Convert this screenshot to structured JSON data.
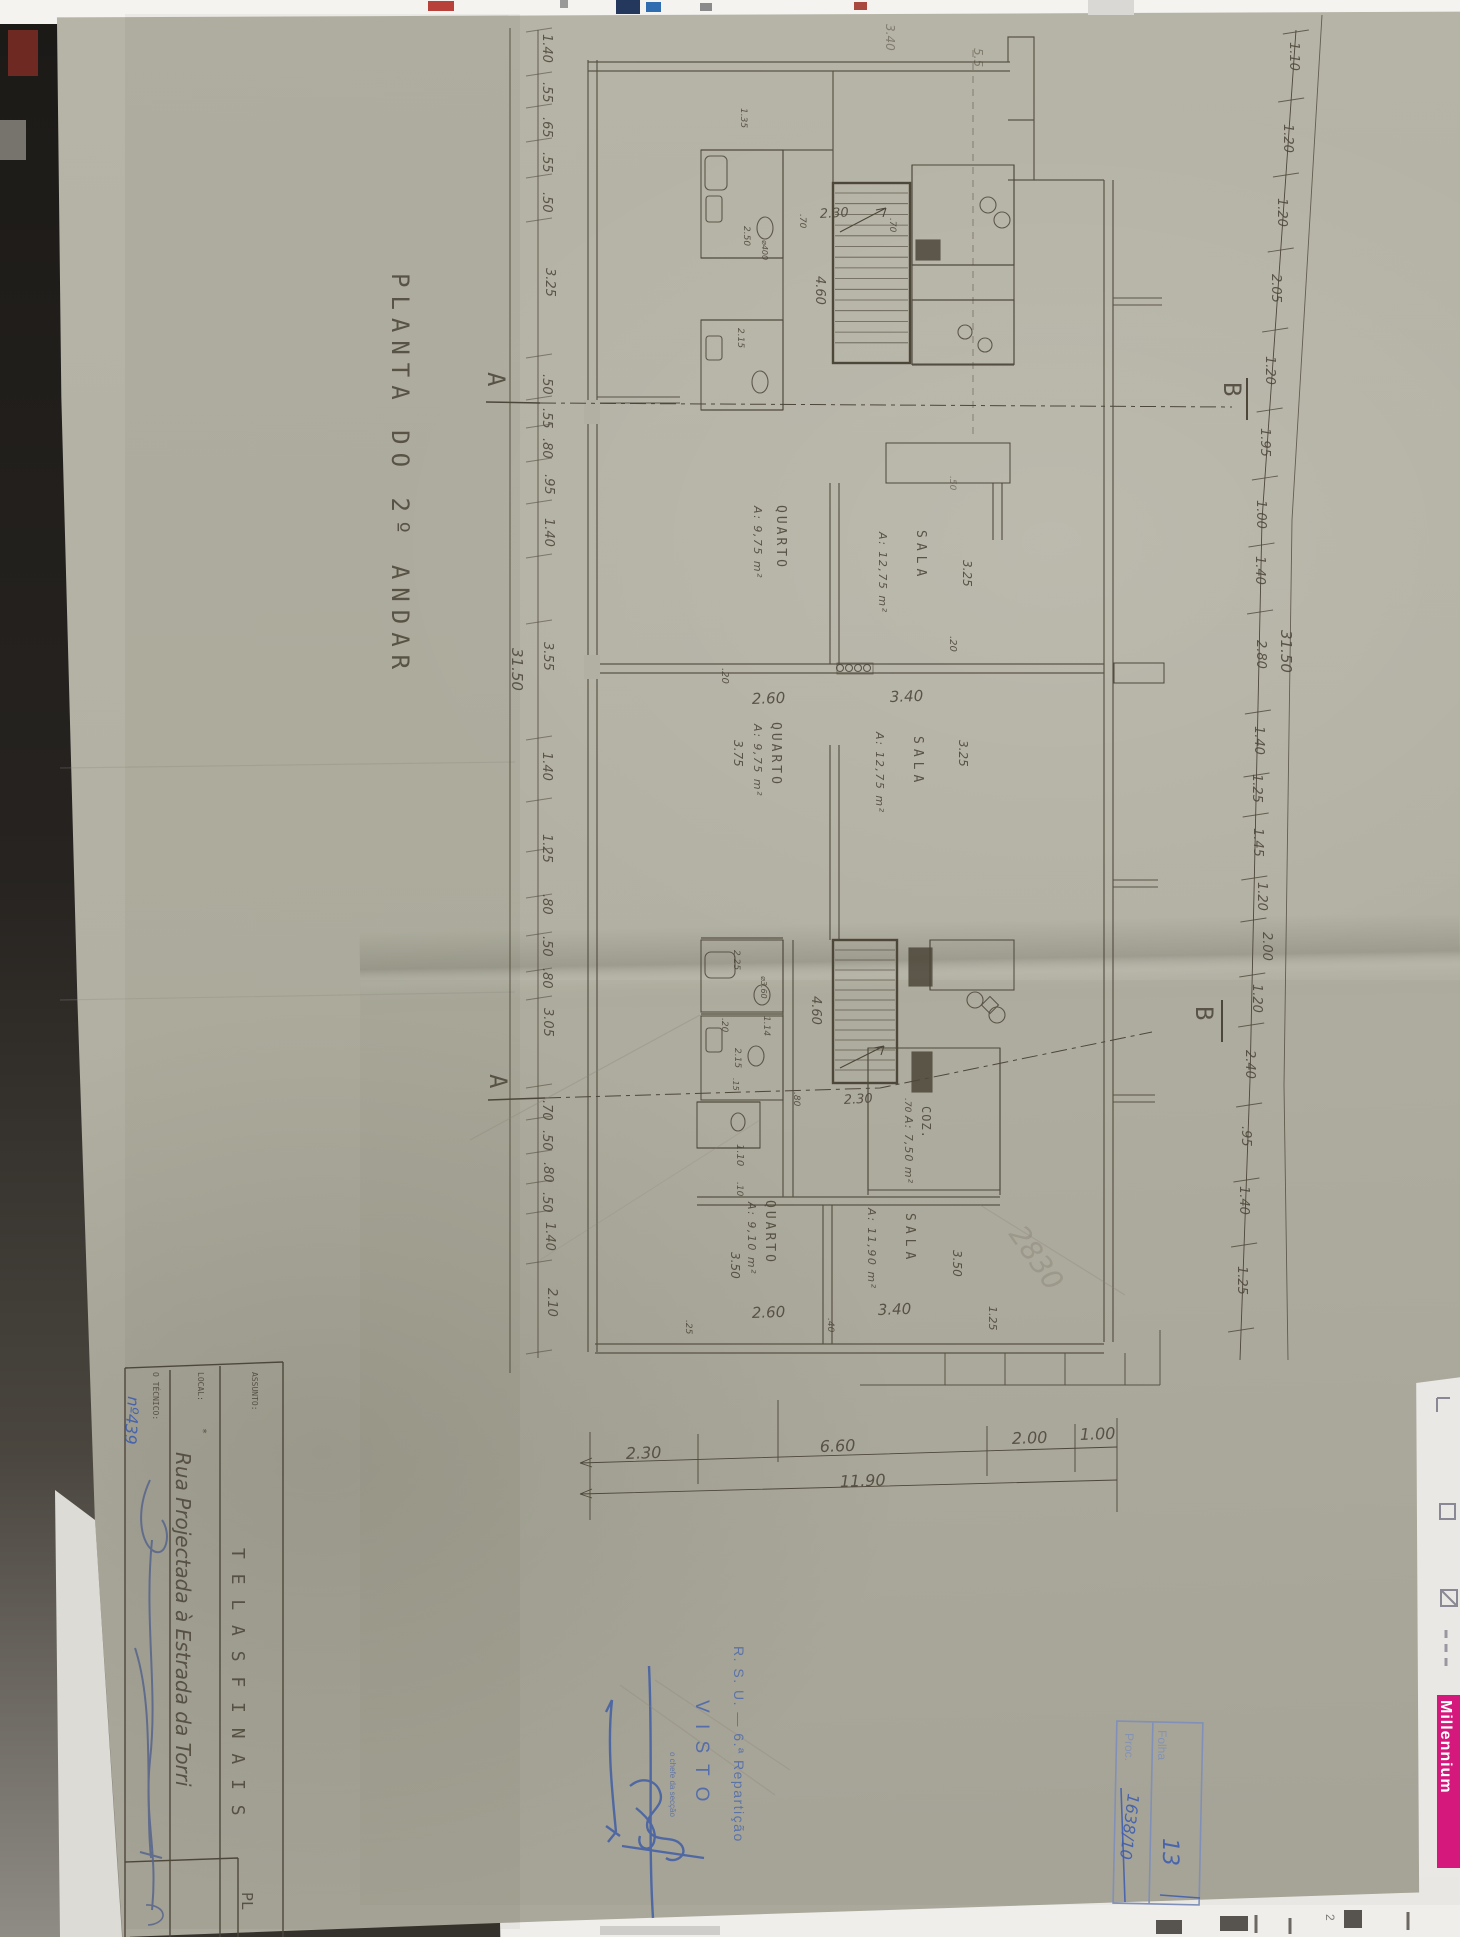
{
  "document_type": "architectural floor plan photograph",
  "texts": [
    {
      "n": "drawing-title",
      "t": "PLANTA  DO  2º ANDAR",
      "x": 392,
      "y": 273,
      "r": 90,
      "s": 24,
      "f": "d",
      "c": "ink",
      "ls": 8
    },
    {
      "n": "dim-left",
      "t": "1.40",
      "x": 543,
      "y": 34,
      "r": 90,
      "s": 13,
      "f": "h"
    },
    {
      "n": "dim-left",
      "t": ".55",
      "x": 543,
      "y": 82,
      "r": 90,
      "s": 13,
      "f": "h"
    },
    {
      "n": "dim-left",
      "t": ".65",
      "x": 543,
      "y": 117,
      "r": 90,
      "s": 13,
      "f": "h"
    },
    {
      "n": "dim-left",
      "t": ".55",
      "x": 543,
      "y": 152,
      "r": 90,
      "s": 13,
      "f": "h"
    },
    {
      "n": "dim-left",
      "t": ".50",
      "x": 543,
      "y": 192,
      "r": 90,
      "s": 13,
      "f": "h"
    },
    {
      "n": "dim-left",
      "t": "3.25",
      "x": 546,
      "y": 268,
      "r": 90,
      "s": 13,
      "f": "h"
    },
    {
      "n": "dim-left",
      "t": ".50",
      "x": 543,
      "y": 374,
      "r": 90,
      "s": 13,
      "f": "h"
    },
    {
      "n": "dim-left",
      "t": ".55",
      "x": 543,
      "y": 408,
      "r": 90,
      "s": 13,
      "f": "h"
    },
    {
      "n": "dim-left",
      "t": ".80",
      "x": 543,
      "y": 438,
      "r": 90,
      "s": 13,
      "f": "h"
    },
    {
      "n": "dim-left",
      "t": ".95",
      "x": 545,
      "y": 474,
      "r": 90,
      "s": 13,
      "f": "h"
    },
    {
      "n": "dim-left",
      "t": "1.40",
      "x": 545,
      "y": 518,
      "r": 90,
      "s": 13,
      "f": "h"
    },
    {
      "n": "dim-left",
      "t": "3.55",
      "x": 544,
      "y": 642,
      "r": 90,
      "s": 13,
      "f": "h"
    },
    {
      "n": "dim-left",
      "t": "1.40",
      "x": 543,
      "y": 752,
      "r": 90,
      "s": 13,
      "f": "h"
    },
    {
      "n": "dim-left",
      "t": "1.25",
      "x": 543,
      "y": 834,
      "r": 90,
      "s": 13,
      "f": "h"
    },
    {
      "n": "dim-left",
      "t": ".80",
      "x": 543,
      "y": 894,
      "r": 90,
      "s": 13,
      "f": "h"
    },
    {
      "n": "dim-left",
      "t": ".50",
      "x": 543,
      "y": 936,
      "r": 90,
      "s": 13,
      "f": "h"
    },
    {
      "n": "dim-left",
      "t": ".80",
      "x": 543,
      "y": 968,
      "r": 90,
      "s": 13,
      "f": "h"
    },
    {
      "n": "dim-left",
      "t": "3.05",
      "x": 544,
      "y": 1008,
      "r": 90,
      "s": 13,
      "f": "h"
    },
    {
      "n": "dim-left",
      "t": ".70",
      "x": 543,
      "y": 1100,
      "r": 90,
      "s": 13,
      "f": "h"
    },
    {
      "n": "dim-left",
      "t": ".50",
      "x": 543,
      "y": 1130,
      "r": 90,
      "s": 13,
      "f": "h"
    },
    {
      "n": "dim-left",
      "t": ".80",
      "x": 544,
      "y": 1162,
      "r": 90,
      "s": 13,
      "f": "h"
    },
    {
      "n": "dim-left",
      "t": ".50",
      "x": 543,
      "y": 1192,
      "r": 90,
      "s": 13,
      "f": "h"
    },
    {
      "n": "dim-left",
      "t": "1.40",
      "x": 546,
      "y": 1222,
      "r": 90,
      "s": 13,
      "f": "h"
    },
    {
      "n": "dim-left",
      "t": "2.10",
      "x": 548,
      "y": 1288,
      "r": 90,
      "s": 13,
      "f": "h"
    },
    {
      "n": "dim-left-total",
      "t": "31.50",
      "x": 512,
      "y": 648,
      "r": 90,
      "s": 15,
      "f": "h"
    },
    {
      "n": "dim-right",
      "t": "1.10",
      "x": 1290,
      "y": 42,
      "r": 90,
      "s": 13,
      "f": "h"
    },
    {
      "n": "dim-right",
      "t": "1.20",
      "x": 1284,
      "y": 124,
      "r": 90,
      "s": 13,
      "f": "h"
    },
    {
      "n": "dim-right",
      "t": "1.20",
      "x": 1278,
      "y": 198,
      "r": 90,
      "s": 13,
      "f": "h"
    },
    {
      "n": "dim-right",
      "t": "2.05",
      "x": 1272,
      "y": 274,
      "r": 90,
      "s": 13,
      "f": "h"
    },
    {
      "n": "dim-right",
      "t": "1.20",
      "x": 1266,
      "y": 356,
      "r": 90,
      "s": 13,
      "f": "h"
    },
    {
      "n": "dim-right",
      "t": "1.95",
      "x": 1261,
      "y": 428,
      "r": 90,
      "s": 13,
      "f": "h"
    },
    {
      "n": "dim-right",
      "t": "1.00",
      "x": 1257,
      "y": 500,
      "r": 90,
      "s": 13,
      "f": "h"
    },
    {
      "n": "dim-right",
      "t": "1.40",
      "x": 1256,
      "y": 556,
      "r": 90,
      "s": 13,
      "f": "h"
    },
    {
      "n": "dim-right",
      "t": "2.80",
      "x": 1257,
      "y": 640,
      "r": 90,
      "s": 13,
      "f": "h"
    },
    {
      "n": "dim-right",
      "t": "1.40",
      "x": 1255,
      "y": 726,
      "r": 90,
      "s": 13,
      "f": "h"
    },
    {
      "n": "dim-right",
      "t": "1.25",
      "x": 1253,
      "y": 774,
      "r": 90,
      "s": 13,
      "f": "h"
    },
    {
      "n": "dim-right",
      "t": "1.45",
      "x": 1254,
      "y": 828,
      "r": 90,
      "s": 13,
      "f": "h"
    },
    {
      "n": "dim-right",
      "t": "1.20",
      "x": 1258,
      "y": 882,
      "r": 90,
      "s": 13,
      "f": "h"
    },
    {
      "n": "dim-right",
      "t": "2.00",
      "x": 1263,
      "y": 932,
      "r": 90,
      "s": 13,
      "f": "h"
    },
    {
      "n": "dim-right",
      "t": "1.20",
      "x": 1253,
      "y": 984,
      "r": 90,
      "s": 13,
      "f": "h"
    },
    {
      "n": "dim-right",
      "t": "2.40",
      "x": 1246,
      "y": 1050,
      "r": 90,
      "s": 13,
      "f": "h"
    },
    {
      "n": "dim-right",
      "t": ".95",
      "x": 1242,
      "y": 1126,
      "r": 90,
      "s": 13,
      "f": "h"
    },
    {
      "n": "dim-right",
      "t": "1.40",
      "x": 1240,
      "y": 1186,
      "r": 90,
      "s": 13,
      "f": "h"
    },
    {
      "n": "dim-right",
      "t": "1.25",
      "x": 1238,
      "y": 1266,
      "r": 90,
      "s": 13,
      "f": "h"
    },
    {
      "n": "dim-right-total",
      "t": "31.50",
      "x": 1281,
      "y": 630,
      "r": 90,
      "s": 15,
      "f": "h"
    },
    {
      "n": "dim-top",
      "t": "3.40",
      "x": 886,
      "y": 24,
      "r": 90,
      "s": 12,
      "f": "h",
      "o": 0.5
    },
    {
      "n": "dim-top",
      "t": "5.5",
      "x": 974,
      "y": 48,
      "r": 90,
      "s": 12,
      "f": "h",
      "o": 0.5
    },
    {
      "n": "dim-bottom",
      "t": "2.30",
      "x": 626,
      "y": 1459,
      "r": -2,
      "s": 16,
      "f": "h"
    },
    {
      "n": "dim-bottom",
      "t": "6.60",
      "x": 820,
      "y": 1452,
      "r": -2,
      "s": 16,
      "f": "h"
    },
    {
      "n": "dim-bottom",
      "t": "2.00",
      "x": 1012,
      "y": 1444,
      "r": -2,
      "s": 16,
      "f": "h"
    },
    {
      "n": "dim-bottom",
      "t": "1.00",
      "x": 1080,
      "y": 1440,
      "r": -2,
      "s": 16,
      "f": "h"
    },
    {
      "n": "dim-bottom-total",
      "t": "11.90",
      "x": 840,
      "y": 1487,
      "r": -2,
      "s": 16,
      "f": "h"
    },
    {
      "n": "section-marker-a1",
      "t": "A",
      "x": 488,
      "y": 372,
      "r": 90,
      "s": 24,
      "f": "d"
    },
    {
      "n": "section-marker-b1",
      "t": "B",
      "x": 1224,
      "y": 382,
      "r": 90,
      "s": 24,
      "f": "d"
    },
    {
      "n": "section-marker-a2",
      "t": "A",
      "x": 490,
      "y": 1074,
      "r": 90,
      "s": 24,
      "f": "d"
    },
    {
      "n": "section-marker-b2",
      "t": "B",
      "x": 1196,
      "y": 1006,
      "r": 90,
      "s": 24,
      "f": "d"
    },
    {
      "n": "room-label-quarto-1",
      "t": "QUARTO",
      "x": 777,
      "y": 505,
      "r": 90,
      "s": 13,
      "f": "d",
      "ls": 3
    },
    {
      "n": "room-area-quarto-1",
      "t": "A: 9,75 m²",
      "x": 754,
      "y": 506,
      "r": 90,
      "s": 11,
      "f": "h",
      "ls": 1.5
    },
    {
      "n": "room-label-sala-1",
      "t": "SALA",
      "x": 917,
      "y": 530,
      "r": 90,
      "s": 13,
      "f": "d",
      "ls": 5
    },
    {
      "n": "room-area-sala-1",
      "t": "A: 12,75 m²",
      "x": 879,
      "y": 532,
      "r": 90,
      "s": 11,
      "f": "h",
      "ls": 1.5
    },
    {
      "n": "room-label-quarto-2",
      "t": "QUARTO",
      "x": 772,
      "y": 722,
      "r": 90,
      "s": 13,
      "f": "d",
      "ls": 3
    },
    {
      "n": "room-area-quarto-2",
      "t": "A: 9,75 m²",
      "x": 754,
      "y": 724,
      "r": 90,
      "s": 11,
      "f": "h",
      "ls": 1.5
    },
    {
      "n": "room-label-sala-2",
      "t": "SALA",
      "x": 914,
      "y": 736,
      "r": 90,
      "s": 13,
      "f": "d",
      "ls": 5
    },
    {
      "n": "room-area-sala-2",
      "t": "A: 12,75 m²",
      "x": 876,
      "y": 732,
      "r": 90,
      "s": 11,
      "f": "h",
      "ls": 1.5
    },
    {
      "n": "room-label-quarto-3",
      "t": "QUARTO",
      "x": 766,
      "y": 1200,
      "r": 90,
      "s": 13,
      "f": "d",
      "ls": 3
    },
    {
      "n": "room-area-quarto-3",
      "t": "A: 9,10 m²",
      "x": 748,
      "y": 1202,
      "r": 90,
      "s": 11,
      "f": "h",
      "ls": 1.5
    },
    {
      "n": "room-label-sala-3",
      "t": "SALA",
      "x": 906,
      "y": 1213,
      "r": 90,
      "s": 13,
      "f": "d",
      "ls": 5
    },
    {
      "n": "room-area-sala-3",
      "t": "A: 11,90 m²",
      "x": 868,
      "y": 1208,
      "r": 90,
      "s": 11,
      "f": "h",
      "ls": 1.5
    },
    {
      "n": "room-label-coz",
      "t": "COZ.",
      "x": 922,
      "y": 1106,
      "r": 90,
      "s": 12,
      "f": "d",
      "ls": 1
    },
    {
      "n": "room-area-coz",
      "t": "A: 7,50 m²",
      "x": 905,
      "y": 1116,
      "r": 90,
      "s": 11,
      "f": "h",
      "ls": 1
    },
    {
      "n": "dim-stair-1",
      "t": "2.30",
      "x": 820,
      "y": 218,
      "r": -3,
      "s": 13,
      "f": "h"
    },
    {
      "n": "dim-stair-1b",
      "t": "4.60",
      "x": 816,
      "y": 276,
      "r": 90,
      "s": 13,
      "f": "h"
    },
    {
      "n": "dim-stair-1c",
      "t": ".70",
      "x": 800,
      "y": 214,
      "r": 90,
      "s": 9,
      "f": "h"
    },
    {
      "n": "dim-stair-1d",
      "t": ".70",
      "x": 890,
      "y": 218,
      "r": 90,
      "s": 9,
      "f": "h"
    },
    {
      "n": "dim-stair-2",
      "t": "2.30",
      "x": 844,
      "y": 1104,
      "r": -3,
      "s": 13,
      "f": "h"
    },
    {
      "n": "dim-stair-2b",
      "t": "4.60",
      "x": 812,
      "y": 996,
      "r": 90,
      "s": 13,
      "f": "h"
    },
    {
      "n": "dim-stair-2c",
      "t": ".70",
      "x": 905,
      "y": 1098,
      "r": 90,
      "s": 9,
      "f": "h"
    },
    {
      "n": "dim-stair-2d",
      "t": ".80",
      "x": 794,
      "y": 1092,
      "r": 90,
      "s": 9,
      "f": "h"
    },
    {
      "n": "dim-mid",
      "t": "2.60",
      "x": 752,
      "y": 704,
      "r": -2,
      "s": 15,
      "f": "h"
    },
    {
      "n": "dim-mid",
      "t": "3.40",
      "x": 890,
      "y": 702,
      "r": -2,
      "s": 15,
      "f": "h"
    },
    {
      "n": "dim-mid",
      "t": ".20",
      "x": 722,
      "y": 668,
      "r": 90,
      "s": 10,
      "f": "h"
    },
    {
      "n": "dim-mid",
      "t": ".20",
      "x": 950,
      "y": 636,
      "r": 90,
      "s": 10,
      "f": "h"
    },
    {
      "n": "dim-mid",
      "t": "3.25",
      "x": 963,
      "y": 560,
      "r": 90,
      "s": 12,
      "f": "h"
    },
    {
      "n": "dim-mid",
      "t": "3.25",
      "x": 959,
      "y": 740,
      "r": 90,
      "s": 12,
      "f": "h"
    },
    {
      "n": "dim-mid",
      "t": "3.75",
      "x": 734,
      "y": 740,
      "r": 90,
      "s": 12,
      "f": "h"
    },
    {
      "n": "dim-mid",
      "t": ".50",
      "x": 950,
      "y": 476,
      "r": 90,
      "s": 9,
      "f": "h",
      "o": 0.6
    },
    {
      "n": "dim-low",
      "t": "2.60",
      "x": 752,
      "y": 1318,
      "r": -2,
      "s": 15,
      "f": "h"
    },
    {
      "n": "dim-low",
      "t": "3.40",
      "x": 878,
      "y": 1315,
      "r": -2,
      "s": 15,
      "f": "h"
    },
    {
      "n": "dim-low",
      "t": "3.50",
      "x": 731,
      "y": 1252,
      "r": 90,
      "s": 12,
      "f": "h"
    },
    {
      "n": "dim-low",
      "t": "3.50",
      "x": 953,
      "y": 1250,
      "r": 90,
      "s": 12,
      "f": "h"
    },
    {
      "n": "dim-low",
      "t": "1.25",
      "x": 989,
      "y": 1306,
      "r": 90,
      "s": 11,
      "f": "h"
    },
    {
      "n": "dim-low",
      "t": ".40",
      "x": 828,
      "y": 1318,
      "r": 90,
      "s": 9,
      "f": "h"
    },
    {
      "n": "dim-low",
      "t": ".25",
      "x": 686,
      "y": 1320,
      "r": 90,
      "s": 9,
      "f": "h"
    },
    {
      "n": "dim-bath",
      "t": "1.35",
      "x": 741,
      "y": 108,
      "r": 90,
      "s": 9,
      "f": "h"
    },
    {
      "n": "dim-bath",
      "t": "2.50",
      "x": 744,
      "y": 226,
      "r": 90,
      "s": 9,
      "f": "h"
    },
    {
      "n": "dim-bath",
      "t": "⌀400",
      "x": 762,
      "y": 240,
      "r": 90,
      "s": 8,
      "f": "h"
    },
    {
      "n": "dim-bath",
      "t": "2.15",
      "x": 738,
      "y": 328,
      "r": 90,
      "s": 9,
      "f": "h"
    },
    {
      "n": "dim-bath",
      "t": "2.25",
      "x": 734,
      "y": 950,
      "r": 90,
      "s": 9,
      "f": "h"
    },
    {
      "n": "dim-bath",
      "t": "⌀3.60",
      "x": 761,
      "y": 976,
      "r": 90,
      "s": 8,
      "f": "h"
    },
    {
      "n": "dim-bath",
      "t": ".20",
      "x": 722,
      "y": 1018,
      "r": 90,
      "s": 9,
      "f": "h"
    },
    {
      "n": "dim-bath",
      "t": "1.14",
      "x": 764,
      "y": 1016,
      "r": 90,
      "s": 9,
      "f": "h"
    },
    {
      "n": "dim-bath",
      "t": "2.15",
      "x": 735,
      "y": 1048,
      "r": 90,
      "s": 9,
      "f": "h"
    },
    {
      "n": "dim-bath",
      "t": ".15",
      "x": 733,
      "y": 1078,
      "r": 90,
      "s": 8,
      "f": "h"
    },
    {
      "n": "dim-bath",
      "t": "1.10",
      "x": 737,
      "y": 1144,
      "r": 90,
      "s": 10,
      "f": "h"
    },
    {
      "n": "dim-bath",
      "t": ".10",
      "x": 737,
      "y": 1182,
      "r": 90,
      "s": 9,
      "f": "h"
    },
    {
      "n": "pencil-note",
      "t": "2830",
      "x": 1008,
      "y": 1234,
      "r": 55,
      "s": 28,
      "f": "h",
      "c": "pencil",
      "o": 0.5
    },
    {
      "n": "titleblock-assunto-label",
      "t": "ASSUNTO:",
      "x": 252,
      "y": 1372,
      "r": 90,
      "s": 8,
      "f": "d"
    },
    {
      "n": "titleblock-assunto-value",
      "t": "T E L A S   F I N A I S",
      "x": 232,
      "y": 1548,
      "r": 90,
      "s": 18,
      "f": "d",
      "ls": 2
    },
    {
      "n": "titleblock-local-label",
      "t": "LOCAL:",
      "x": 198,
      "y": 1372,
      "r": 90,
      "s": 8,
      "f": "d"
    },
    {
      "n": "titleblock-local-value",
      "t": "Rua Projectada à Estrada da Torri",
      "x": 176,
      "y": 1452,
      "r": 90,
      "s": 20,
      "f": "h"
    },
    {
      "n": "titleblock-local-mark",
      "t": "*",
      "x": 200,
      "y": 1428,
      "r": 90,
      "s": 10,
      "f": "d"
    },
    {
      "n": "titleblock-tecnico-label",
      "t": "O TÉCNICO:",
      "x": 153,
      "y": 1372,
      "r": 90,
      "s": 8,
      "f": "d"
    },
    {
      "n": "titleblock-tecnico-number",
      "t": "nº439",
      "x": 128,
      "y": 1396,
      "r": 94,
      "s": 16,
      "f": "h",
      "c": "blue3"
    },
    {
      "n": "titleblock-corner",
      "t": "PL",
      "x": 242,
      "y": 1892,
      "r": 90,
      "s": 15,
      "f": "d"
    },
    {
      "n": "stamp-rsu",
      "t": "R. S. U. — 6.ª Repartição",
      "x": 734,
      "y": 1646,
      "r": 90,
      "s": 14,
      "f": "s",
      "c": "blue",
      "ls": 1.5,
      "o": 0.8
    },
    {
      "n": "stamp-visto",
      "t": "V I S T O",
      "x": 696,
      "y": 1700,
      "r": 90,
      "s": 19,
      "f": "s",
      "c": "blue",
      "ls": 3
    },
    {
      "n": "stamp-chefe",
      "t": "o chefe da secção",
      "x": 670,
      "y": 1752,
      "r": 90,
      "s": 8,
      "f": "s",
      "c": "blue",
      "o": 0.75
    },
    {
      "n": "process-box-folha-label",
      "t": "Folha",
      "x": 1158,
      "y": 1730,
      "r": 90,
      "s": 12,
      "f": "s",
      "c": "blue2"
    },
    {
      "n": "process-box-folha-value",
      "t": "13",
      "x": 1163,
      "y": 1838,
      "r": 90,
      "s": 22,
      "f": "h",
      "c": "blue3"
    },
    {
      "n": "process-box-proc-label",
      "t": "Proc.",
      "x": 1125,
      "y": 1733,
      "r": 90,
      "s": 12,
      "f": "s",
      "c": "blue2"
    },
    {
      "n": "process-box-proc-value",
      "t": "1638/10",
      "x": 1128,
      "y": 1793,
      "r": 97,
      "s": 16,
      "f": "h",
      "c": "blue3"
    },
    {
      "n": "edge-banner",
      "t": "Millennium",
      "x": 1441,
      "y": 1700,
      "r": 90,
      "s": 16,
      "f": "b",
      "c": "white",
      "ls": 1,
      "o": 1
    },
    {
      "n": "edge-mark",
      "t": "2",
      "x": 1326,
      "y": 1914,
      "r": 90,
      "s": 12,
      "f": "s",
      "c": "gray"
    }
  ]
}
